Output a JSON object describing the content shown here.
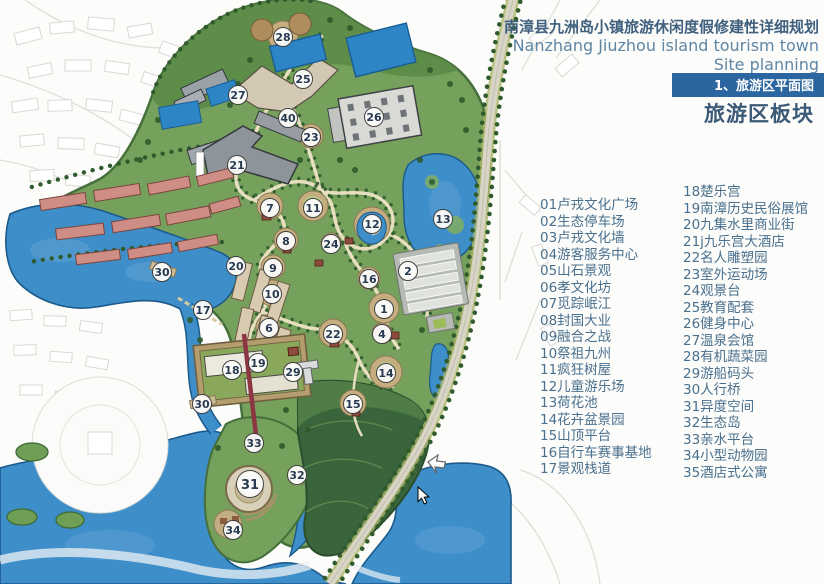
{
  "header": {
    "title_cn": "南漳县九洲岛小镇旅游休闲度假修建性详细规划",
    "title_en1": "Nanzhang Jiuzhou island tourism town",
    "title_en2": "Site planning",
    "section_tab": "1、旅游区平面图",
    "section_title": "旅游区板块"
  },
  "legend": {
    "col1": [
      {
        "no": "01",
        "label": "卢戎文化广场"
      },
      {
        "no": "02",
        "label": "生态停车场"
      },
      {
        "no": "03",
        "label": "卢戎文化墙"
      },
      {
        "no": "04",
        "label": "游客服务中心"
      },
      {
        "no": "05",
        "label": "山石景观"
      },
      {
        "no": "06",
        "label": "孝文化坊"
      },
      {
        "no": "07",
        "label": "觅踪岷江"
      },
      {
        "no": "08",
        "label": "封国大业"
      },
      {
        "no": "09",
        "label": "融合之战"
      },
      {
        "no": "10",
        "label": "祭祖九州"
      },
      {
        "no": "11",
        "label": "疯狂树屋"
      },
      {
        "no": "12",
        "label": "儿童游乐场"
      },
      {
        "no": "13",
        "label": "荷花池"
      },
      {
        "no": "14",
        "label": "花卉盆景园"
      },
      {
        "no": "15",
        "label": "山顶平台"
      },
      {
        "no": "16",
        "label": "自行车赛事基地"
      },
      {
        "no": "17",
        "label": "景观栈道"
      }
    ],
    "col2": [
      {
        "no": "18",
        "label": "楚乐宫"
      },
      {
        "no": "19",
        "label": "南漳历史民俗展馆"
      },
      {
        "no": "20",
        "label": "九集水里商业街"
      },
      {
        "no": "21j",
        "label": "九乐宫大酒店"
      },
      {
        "no": "22",
        "label": "名人雕塑园"
      },
      {
        "no": "23",
        "label": "室外运动场"
      },
      {
        "no": "24",
        "label": "观景台"
      },
      {
        "no": "25",
        "label": "教育配套"
      },
      {
        "no": "26",
        "label": "健身中心"
      },
      {
        "no": "27",
        "label": "温泉会馆"
      },
      {
        "no": "28",
        "label": "有机蔬菜园"
      },
      {
        "no": "29",
        "label": "游船码头"
      },
      {
        "no": "30",
        "label": "人行桥"
      },
      {
        "no": "31",
        "label": "异度空间"
      },
      {
        "no": "32",
        "label": "生态岛"
      },
      {
        "no": "33",
        "label": "亲水平台"
      },
      {
        "no": "34",
        "label": "小型动物园"
      },
      {
        "no": "35",
        "label": "酒店式公寓"
      }
    ]
  },
  "map": {
    "markers": [
      {
        "n": "28",
        "x": 283,
        "y": 37
      },
      {
        "n": "25",
        "x": 303,
        "y": 79
      },
      {
        "n": "27",
        "x": 238,
        "y": 95
      },
      {
        "n": "40",
        "x": 288,
        "y": 118
      },
      {
        "n": "26",
        "x": 374,
        "y": 117
      },
      {
        "n": "23",
        "x": 311,
        "y": 137
      },
      {
        "n": "21",
        "x": 237,
        "y": 165
      },
      {
        "n": "7",
        "x": 270,
        "y": 208
      },
      {
        "n": "11",
        "x": 313,
        "y": 208
      },
      {
        "n": "12",
        "x": 372,
        "y": 224
      },
      {
        "n": "13",
        "x": 443,
        "y": 219
      },
      {
        "n": "8",
        "x": 286,
        "y": 241
      },
      {
        "n": "24",
        "x": 331,
        "y": 244
      },
      {
        "n": "20",
        "x": 236,
        "y": 266
      },
      {
        "n": "9",
        "x": 273,
        "y": 268
      },
      {
        "n": "2",
        "x": 408,
        "y": 271
      },
      {
        "n": "30",
        "x": 162,
        "y": 272
      },
      {
        "n": "16",
        "x": 369,
        "y": 279
      },
      {
        "n": "10",
        "x": 272,
        "y": 294
      },
      {
        "n": "1",
        "x": 384,
        "y": 309
      },
      {
        "n": "17",
        "x": 203,
        "y": 310
      },
      {
        "n": "6",
        "x": 269,
        "y": 328
      },
      {
        "n": "22",
        "x": 333,
        "y": 334
      },
      {
        "n": "4",
        "x": 382,
        "y": 334
      },
      {
        "n": "19",
        "x": 258,
        "y": 363
      },
      {
        "n": "18",
        "x": 232,
        "y": 370
      },
      {
        "n": "29",
        "x": 293,
        "y": 372
      },
      {
        "n": "14",
        "x": 386,
        "y": 373
      },
      {
        "n": "30",
        "x": 202,
        "y": 404
      },
      {
        "n": "15",
        "x": 353,
        "y": 404
      },
      {
        "n": "33",
        "x": 254,
        "y": 443
      },
      {
        "n": "32",
        "x": 297,
        "y": 475
      },
      {
        "n": "31",
        "x": 250,
        "y": 484,
        "big": true
      },
      {
        "n": "34",
        "x": 233,
        "y": 530
      }
    ],
    "cursor": {
      "x": 418,
      "y": 487
    }
  },
  "colors": {
    "accent_blue": "#2c66a0",
    "text_blue": "#4a708e",
    "water": "#3d8ec9",
    "green": "#76a15c",
    "hill": "#3a653c"
  }
}
